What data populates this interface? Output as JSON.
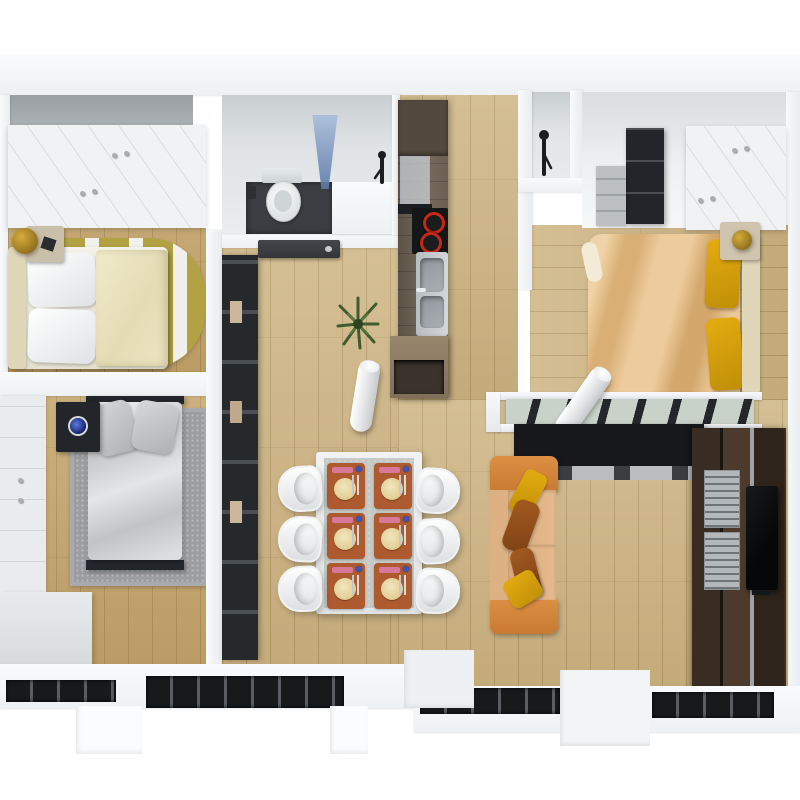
{
  "meta": {
    "description": "3D architectural floor plan of a two/three-bedroom apartment, rendered top-down. No text is visible in the image.",
    "view": "top-down 3d render",
    "counts": {
      "bedrooms": 3,
      "dining_chairs": 6,
      "place_settings": 6,
      "sofa_pillows": 4,
      "cooktop_burners": 2,
      "facade_windows": 4,
      "rolled_tubes": 2
    }
  },
  "palette": {
    "bg": "#ffffff",
    "wallLight": "#f6f8f9",
    "wallGray": "#9aa0a3",
    "woodFloor": "#cdb484",
    "woodWarm": "#c4a46c",
    "tileDark": "#3b3f43",
    "darkFurniture": "#22262a",
    "olive": "#b2a243",
    "cream": "#ece5c1",
    "grayRug": "#9c9da0",
    "tan": "#e7c18c",
    "yellow": "#e3ac10",
    "brown": "#a35a1e",
    "gold": "#d6ab3c",
    "sofaOrange": "#dd8f44",
    "sofaSeat": "#e4ba8e",
    "terracotta": "#ad5a2e",
    "plate": "#e3cf97",
    "burnerRed": "#c42818",
    "glassBlue": "#5c79a8",
    "plantGreen": "#3f5c30",
    "windowDark": "#17191b",
    "tvBlack": "#0a0c0e",
    "steel": "#c3c7ca"
  },
  "rooms": [
    {
      "name": "bedroom-top-left",
      "furniture": [
        "white-wardrobe",
        "double-bed",
        "two-white-pillows",
        "cream-duvet",
        "headboard",
        "nightstand",
        "gold-lamp",
        "olive-striped-rug"
      ]
    },
    {
      "name": "bedroom-left",
      "furniture": [
        "panel-wardrobe",
        "gray-single-bed",
        "two-gray-pillows",
        "gray-rug",
        "dark-nightstand",
        "blue-alarm-clock",
        "white-dresser"
      ]
    },
    {
      "name": "hallway",
      "furniture": [
        "dark-shelving-unit",
        "open-dark-door",
        "potted-plant",
        "rolled-rug-tube"
      ]
    },
    {
      "name": "bathroom",
      "furniture": [
        "toilet",
        "paper-holder",
        "dark-floor-tiles",
        "shower-glass-panel",
        "half-wall",
        "shower-head"
      ]
    },
    {
      "name": "kitchen",
      "furniture": [
        "dark-wood-counter",
        "tall-cabinet",
        "glass-upstand",
        "cooktop-two-red-burners",
        "stainless-sink",
        "faucet",
        "open-shelf-end-cabinet"
      ]
    },
    {
      "name": "shower-room",
      "furniture": [
        "wall-shower-fixture"
      ]
    },
    {
      "name": "bedroom-top-right",
      "furniture": [
        "white-wardrobe",
        "dark-wardrobe",
        "gray-shelf-cabinet",
        "double-bed",
        "tan-duvet",
        "two-yellow-pillows",
        "headboard",
        "nightstand",
        "gold-lamp",
        "glass-partition-black-frame",
        "dark-sideboard",
        "rolled-rug-tube"
      ]
    },
    {
      "name": "living-dining",
      "furniture": [
        "dining-table",
        "six-white-chairs",
        "six-terracotta-place-settings",
        "orange-sofa",
        "yellow-and-brown-pillows",
        "tv-wall-unit",
        "silver-racks",
        "flat-tv"
      ]
    },
    {
      "name": "south-facade",
      "furniture": [
        "window-strip-1",
        "window-strip-2",
        "window-strip-3",
        "window-strip-4",
        "wall-stubs"
      ]
    }
  ]
}
